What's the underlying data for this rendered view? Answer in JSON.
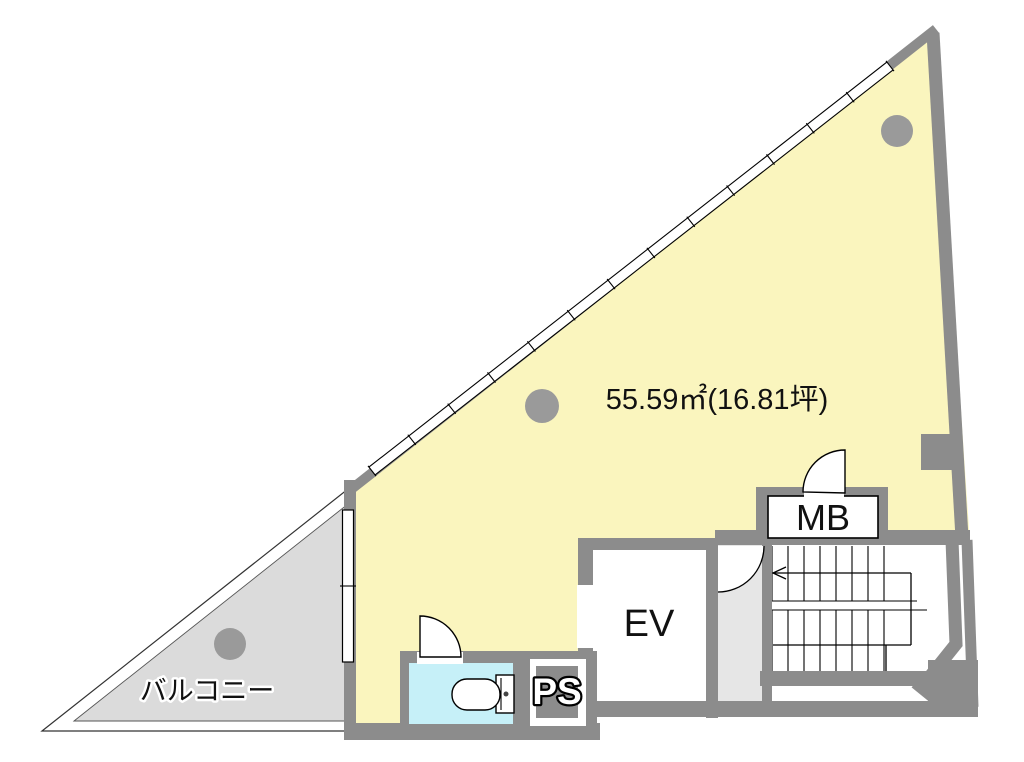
{
  "floorplan": {
    "area_label": "55.59㎡(16.81坪)",
    "balcony_label": "バルコニー",
    "elevator_label": "EV",
    "mailbox_label": "MB",
    "pipe_space_label": "PS",
    "colors": {
      "room_fill": "#FAF5BE",
      "balcony_fill": "#DBDBDB",
      "corridor_fill": "#E6E6E6",
      "toilet_fill": "#C6F0F8",
      "wall": "#8C8C8C",
      "column": "#9A9A9A",
      "line": "#000000"
    }
  }
}
